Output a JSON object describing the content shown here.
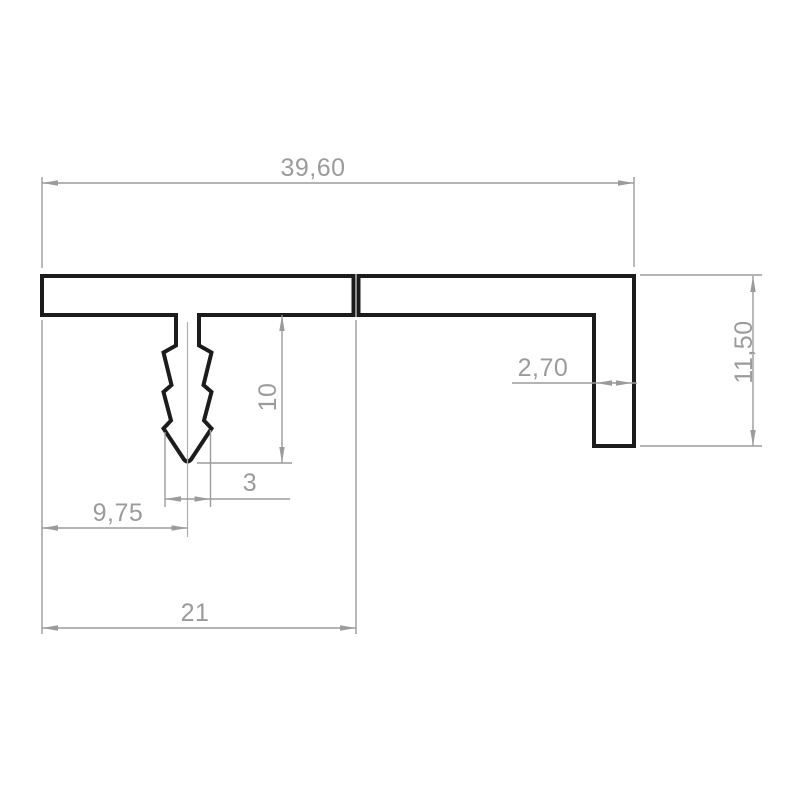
{
  "drawing": {
    "kind": "technical-profile-cross-section",
    "colors": {
      "outline": "#1c1c1c",
      "dimension": "#9b9b9b",
      "background": "#ffffff"
    },
    "dimensions": {
      "total_width": "39,60",
      "leg_height": "11,50",
      "leg_thickness": "2,70",
      "barb_height": "10",
      "barb_width": "3",
      "barb_offset": "9,75",
      "left_section_width": "21"
    }
  }
}
